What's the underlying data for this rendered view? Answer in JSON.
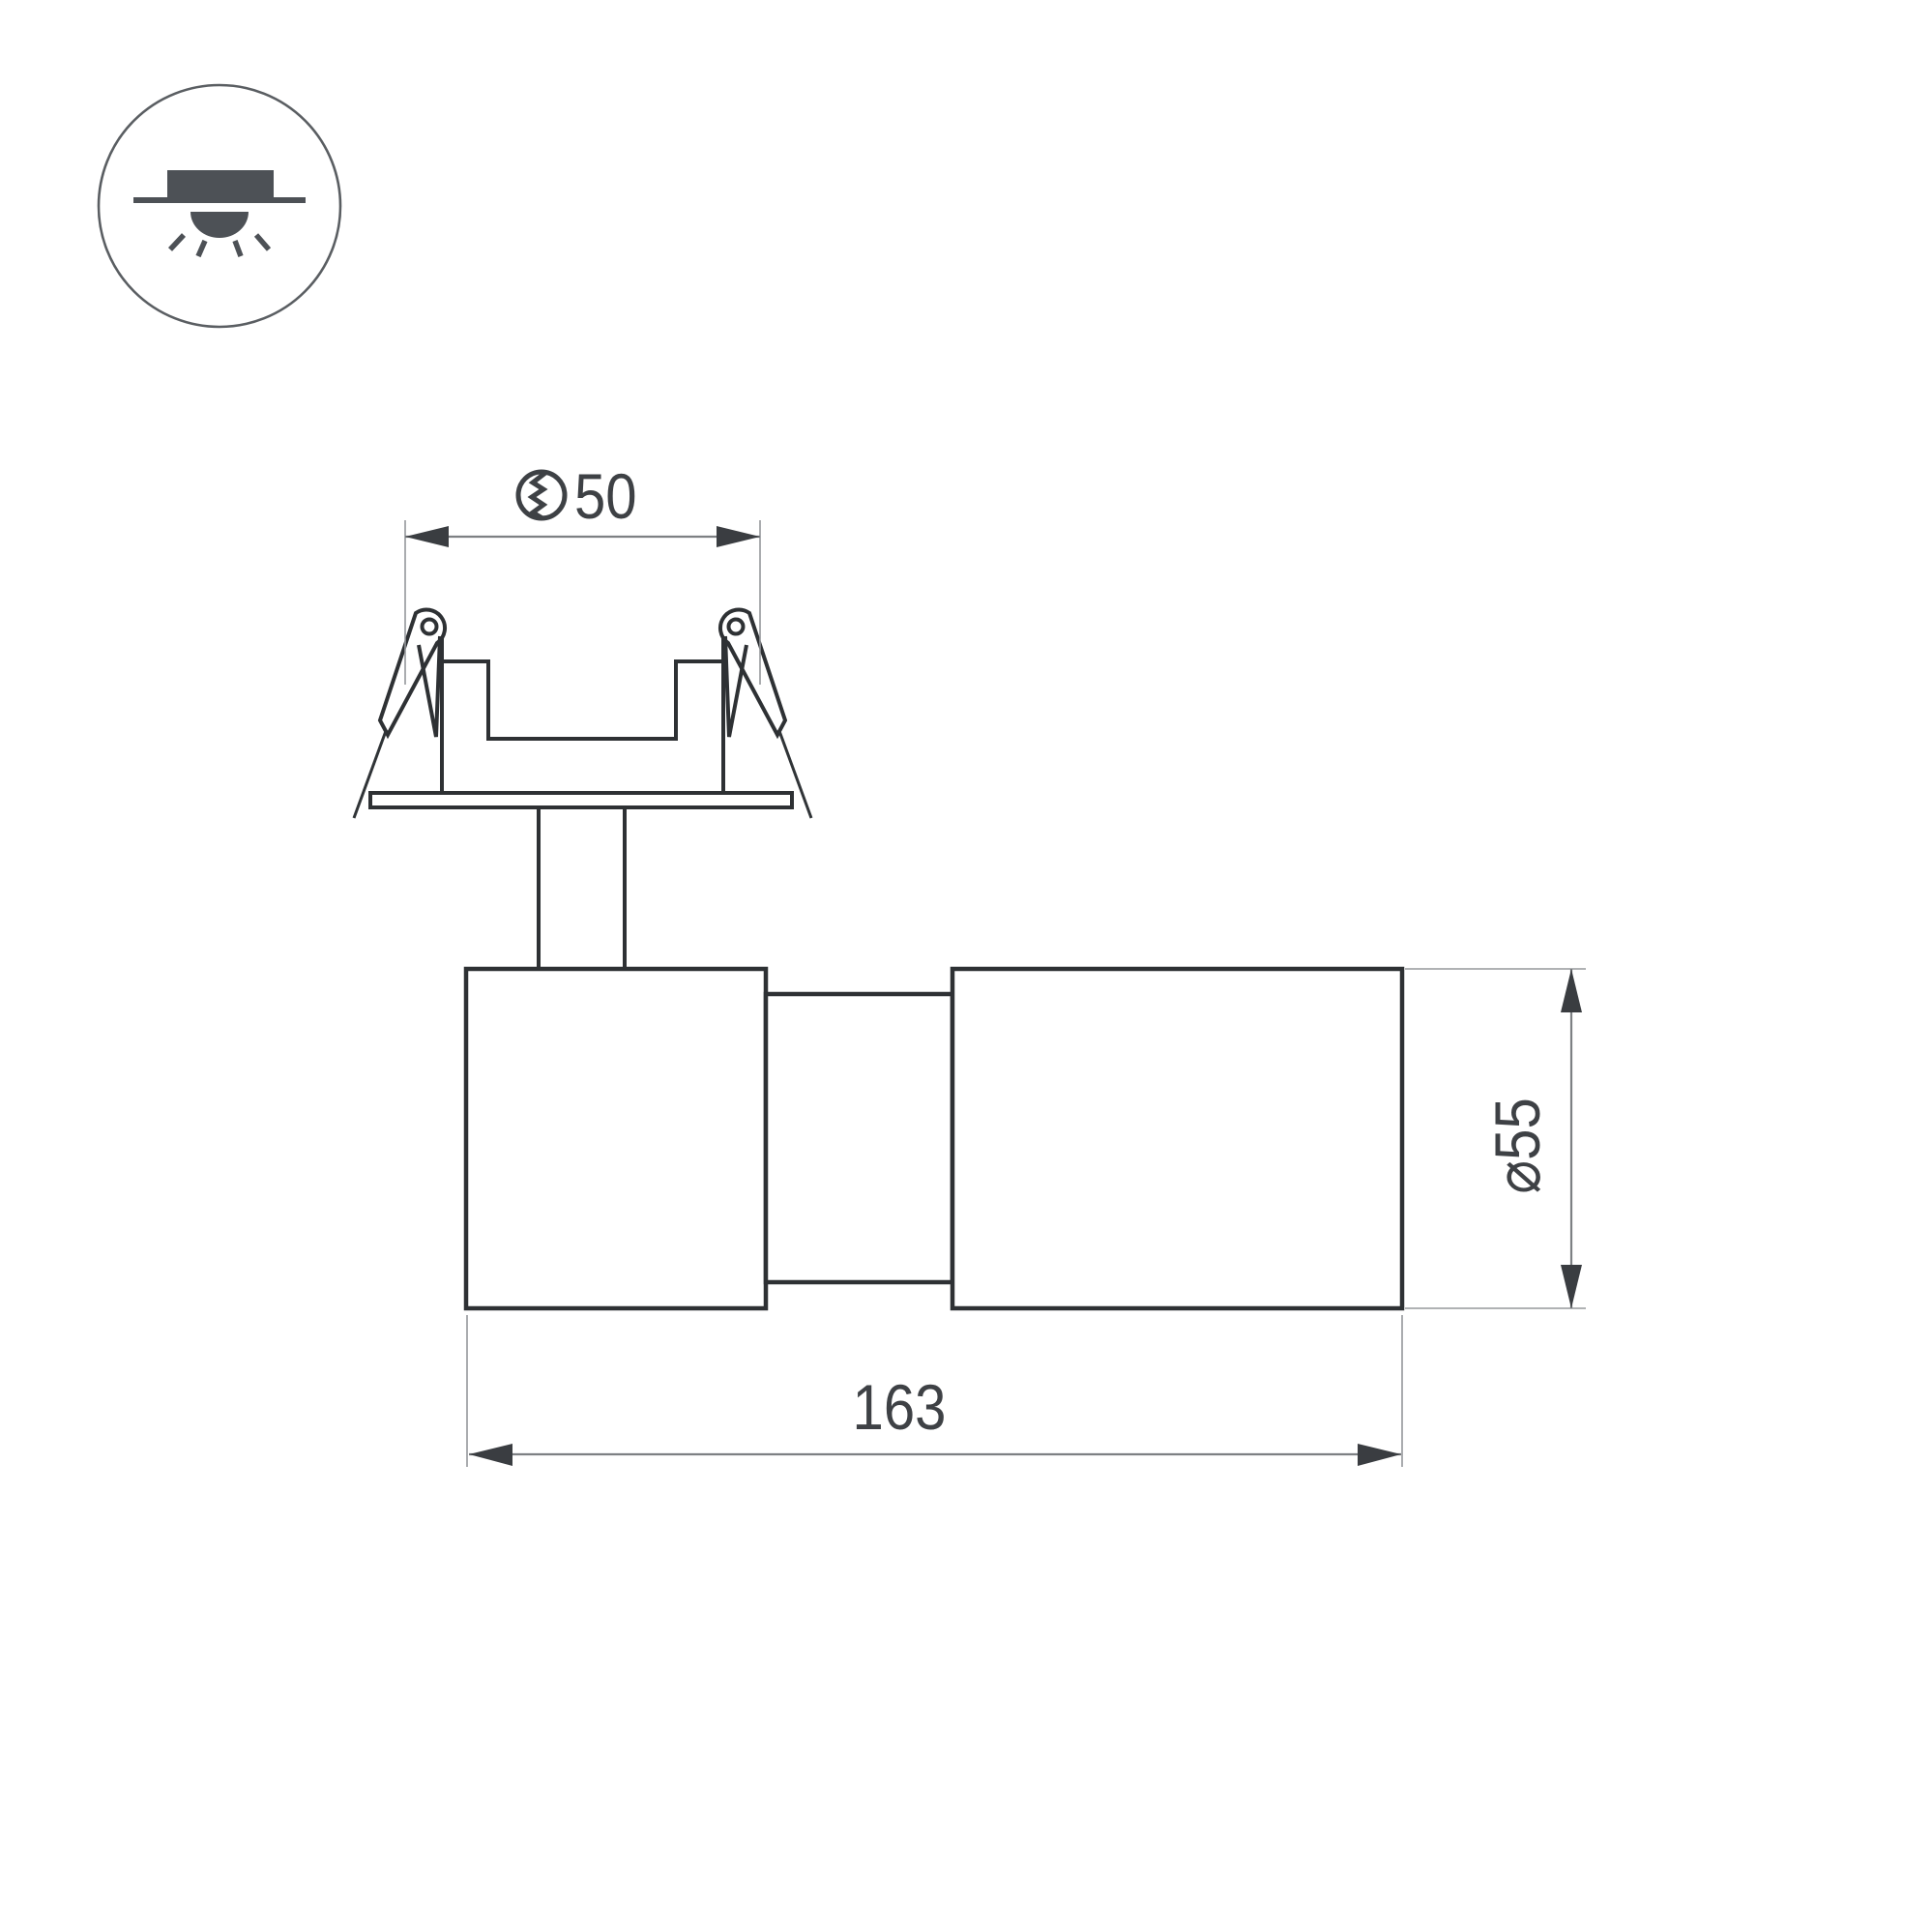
{
  "page": {
    "background": "#ffffff",
    "type": "luminaire-technical-drawing"
  },
  "icon": {
    "name": "recessed-downlight-symbol",
    "description": "circle badge with recessed ceiling spotlight and light rays"
  },
  "dims": {
    "cutout_value": "50",
    "cutout_symbol": "hole-cutout-icon",
    "length_value": "163",
    "diameter_label": "⌀55"
  },
  "colors": {
    "outline": "#2e3134",
    "dimension_line": "#7d8083",
    "extension_line": "#95989b",
    "arrowhead": "#3a3d41",
    "dimension_text": "#3e4145",
    "icon": "#4d5156"
  }
}
